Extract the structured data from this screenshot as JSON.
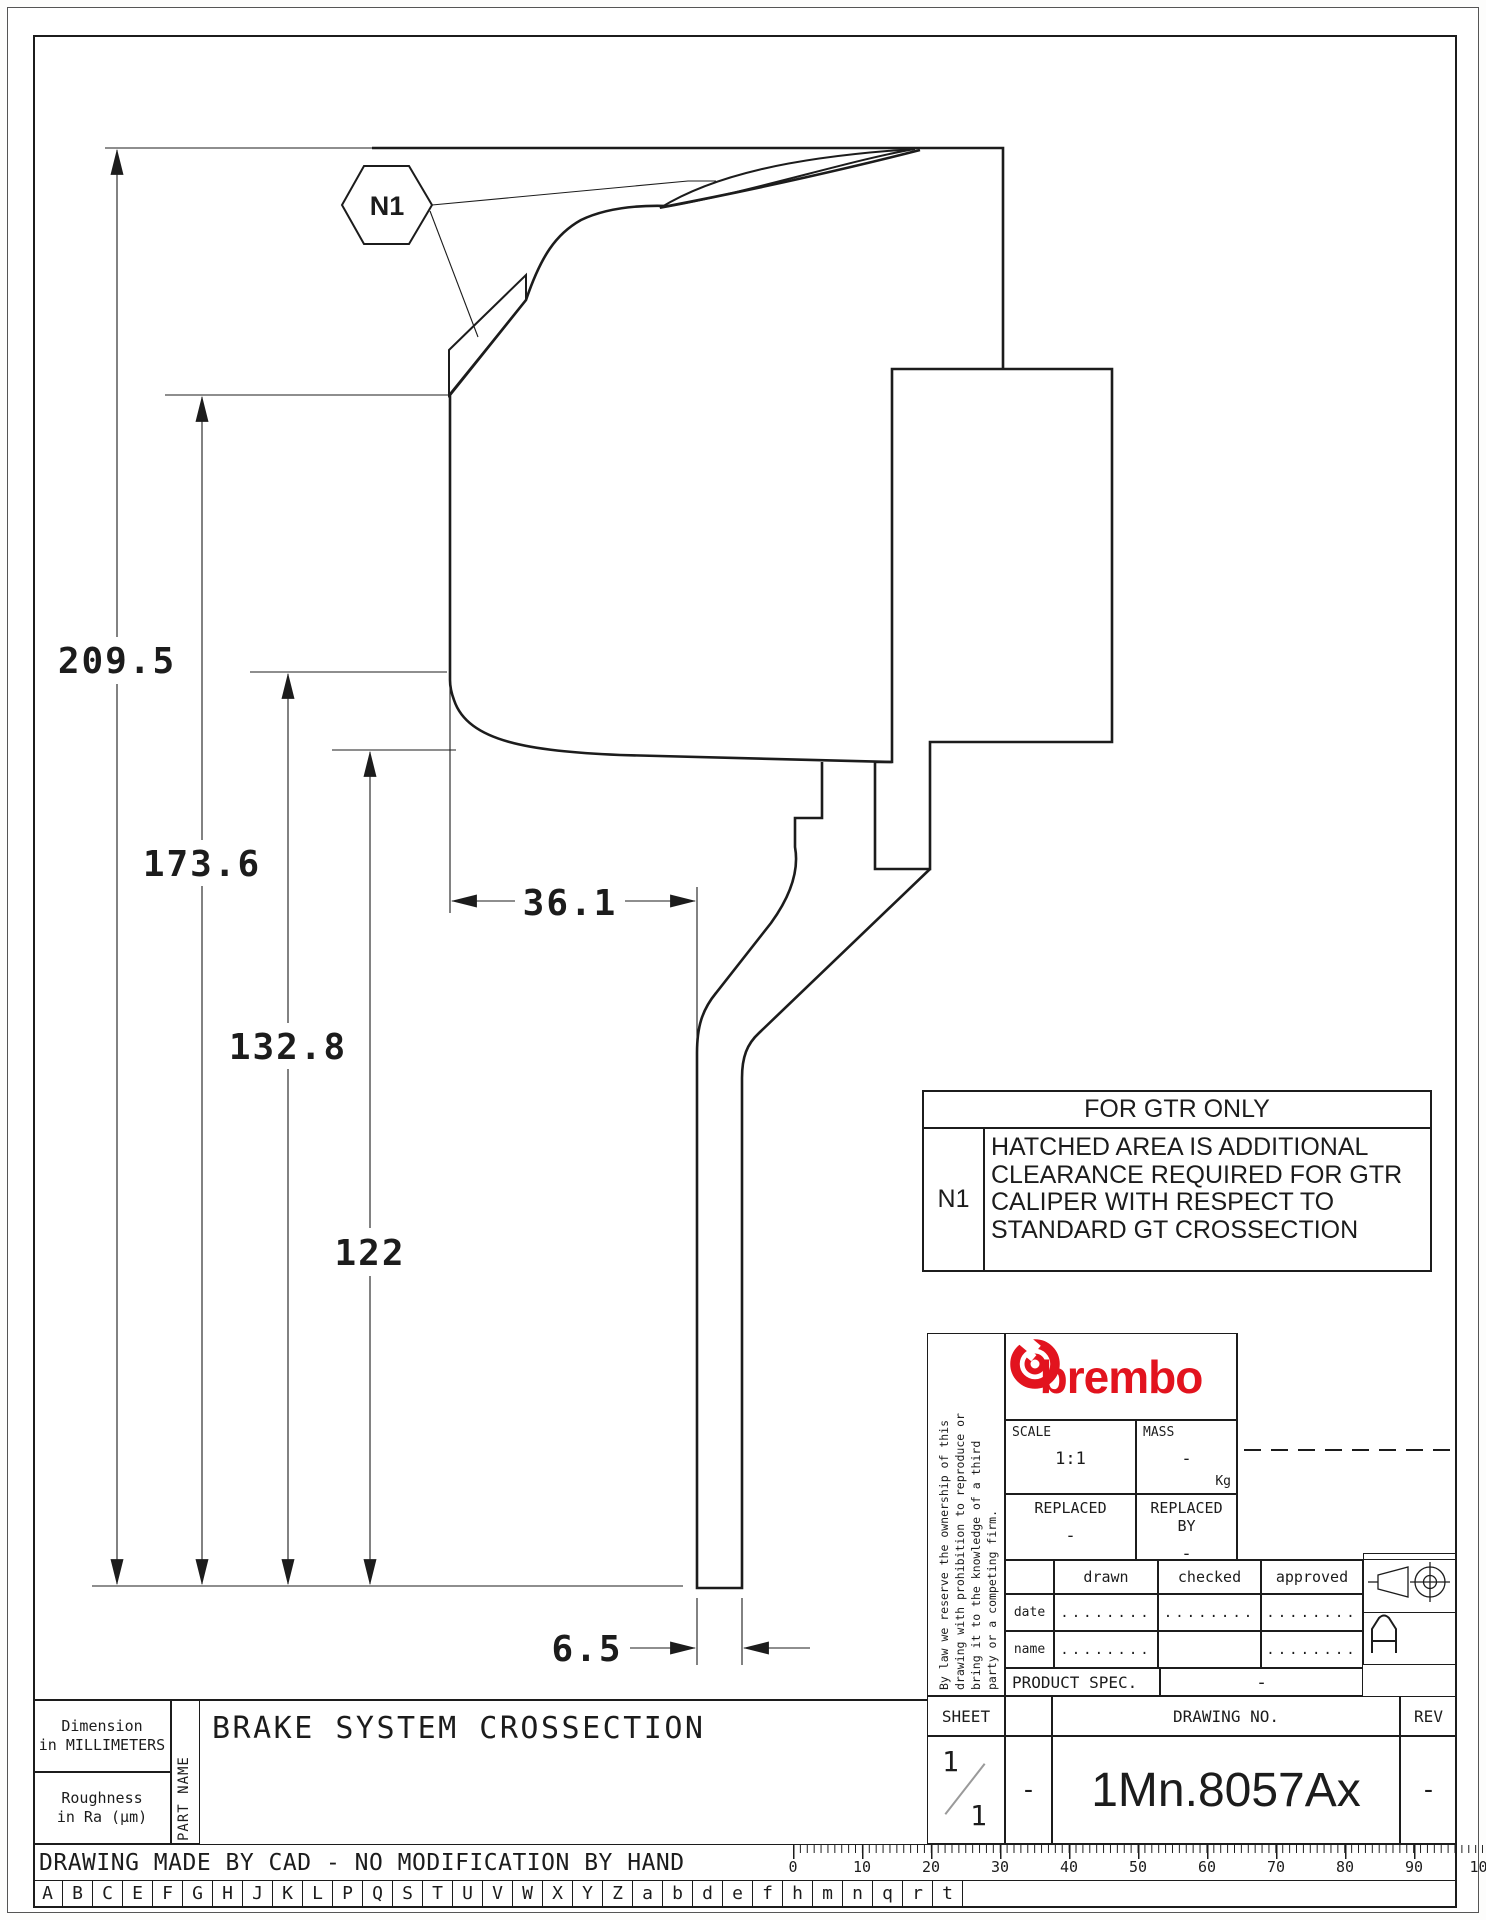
{
  "drawing": {
    "callout_label": "N1",
    "dim_overall": "209.5",
    "dim_mid1": "173.6",
    "dim_mid2": "132.8",
    "dim_mid3": "122",
    "dim_width": "36.1",
    "dim_disc": "6.5"
  },
  "note_box": {
    "header": "FOR GTR ONLY",
    "ref": "N1",
    "lines": [
      "HATCHED AREA IS ADDITIONAL",
      "CLEARANCE REQUIRED FOR GTR",
      "CALIPER WITH RESPECT TO",
      "STANDARD GT CROSSECTION"
    ]
  },
  "title_block": {
    "legal_lines": [
      "By law we reserve the ownership of this",
      "drawing with prohibition to reproduce or",
      "bring it to the knowledge of a third",
      "party or a competing firm."
    ],
    "brand": "brembo",
    "scale_label": "SCALE",
    "scale_value": "1:1",
    "mass_label": "MASS",
    "mass_value": "-",
    "mass_unit": "Kg",
    "replaced_label": "REPLACED",
    "replaced_value": "-",
    "replaced_by_label": "REPLACED BY",
    "replaced_by_value": "-",
    "drawn_label": "drawn",
    "checked_label": "checked",
    "approved_label": "approved",
    "date_label": "date",
    "name_label": "name",
    "dots": "........",
    "product_spec_label": "PRODUCT SPEC.",
    "product_spec_value": "-",
    "sheet_label": "SHEET",
    "sheet_numerator": "1",
    "sheet_denominator": "1",
    "sheet_dash": "-",
    "drawing_no_label": "DRAWING NO.",
    "drawing_no": "1Mn.8057Ax",
    "rev_label": "REV",
    "rev_value": "-",
    "size_symbol": "A"
  },
  "footer": {
    "dimension_note": [
      "Dimension",
      "in MILLIMETERS"
    ],
    "roughness_note": [
      "Roughness",
      "in Ra (µm)"
    ],
    "part_name_label": "PART NAME",
    "part_name": "BRAKE SYSTEM CROSSECTION",
    "cad_note": "DRAWING MADE BY CAD - NO MODIFICATION BY HAND"
  },
  "ruler": {
    "labels": [
      "0",
      "10",
      "20",
      "30",
      "40",
      "50",
      "60",
      "70",
      "80",
      "90",
      "100"
    ]
  },
  "revision_letters": [
    "A",
    "B",
    "C",
    "E",
    "F",
    "G",
    "H",
    "J",
    "K",
    "L",
    "P",
    "Q",
    "S",
    "T",
    "U",
    "V",
    "W",
    "X",
    "Y",
    "Z",
    "a",
    "b",
    "d",
    "e",
    "f",
    "h",
    "m",
    "n",
    "q",
    "r",
    "t"
  ],
  "colors": {
    "line": "#1c1c1c",
    "brand_red": "#e2131e"
  }
}
